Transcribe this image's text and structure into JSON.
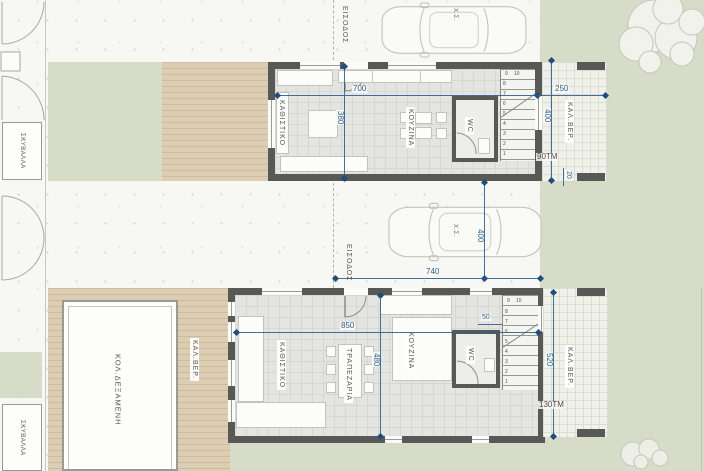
{
  "plan": {
    "site": {
      "garbage_top": "ΣΚΥΒΑΛΛΑ",
      "garbage_bottom": "ΣΚΥΒΑΛΛΑ",
      "pool": "ΚΟΛ.ΔΕΞΑΜΕΝΗ",
      "pool_veranda": "ΚΑΛ.ΒΕΡ."
    },
    "unit_a": {
      "entrance": "ΕΙΣΟΔΟΣ",
      "car": "Χ.Σ.",
      "living": "ΚΑΘΙΣΤΙΚΟ",
      "kitchen": "ΚΟΥΖΙΝΑ",
      "wc": "WC",
      "veranda": "ΚΑΛ.ΒΕΡ.",
      "dims": {
        "width": "700",
        "depth": "380",
        "veranda_width": "250",
        "veranda_depth": "400",
        "gap": "20",
        "area": "90ΤΜ"
      },
      "stairs": [
        "1",
        "2",
        "3",
        "4",
        "5",
        "6",
        "7",
        "8",
        "9",
        "10"
      ]
    },
    "unit_b": {
      "entrance": "ΕΙΣΟΔΟΣ",
      "car": "Χ.Σ.",
      "living": "ΚΑΘΙΣΤΙΚΟ",
      "dining": "ΤΡΑΠΕΖΑΡΙΑ",
      "kitchen": "ΚΟΥΖΙΝΑ",
      "wc": "WC",
      "veranda": "ΚΑΛ.ΒΕΡ.",
      "dims": {
        "width": "850",
        "depth": "480",
        "drive_width": "740",
        "parking_depth": "400",
        "wc_width": "50",
        "veranda_depth": "520",
        "area": "130ΤΜ"
      },
      "stairs": [
        "1",
        "2",
        "3",
        "4",
        "5",
        "6",
        "7",
        "8",
        "9",
        "10"
      ]
    },
    "colors": {
      "green": "#d7dcc9",
      "deck": "#ddceb3",
      "wall": "#585856",
      "dim_blue": "#2e6091",
      "interior": "#e4e4e1"
    }
  }
}
